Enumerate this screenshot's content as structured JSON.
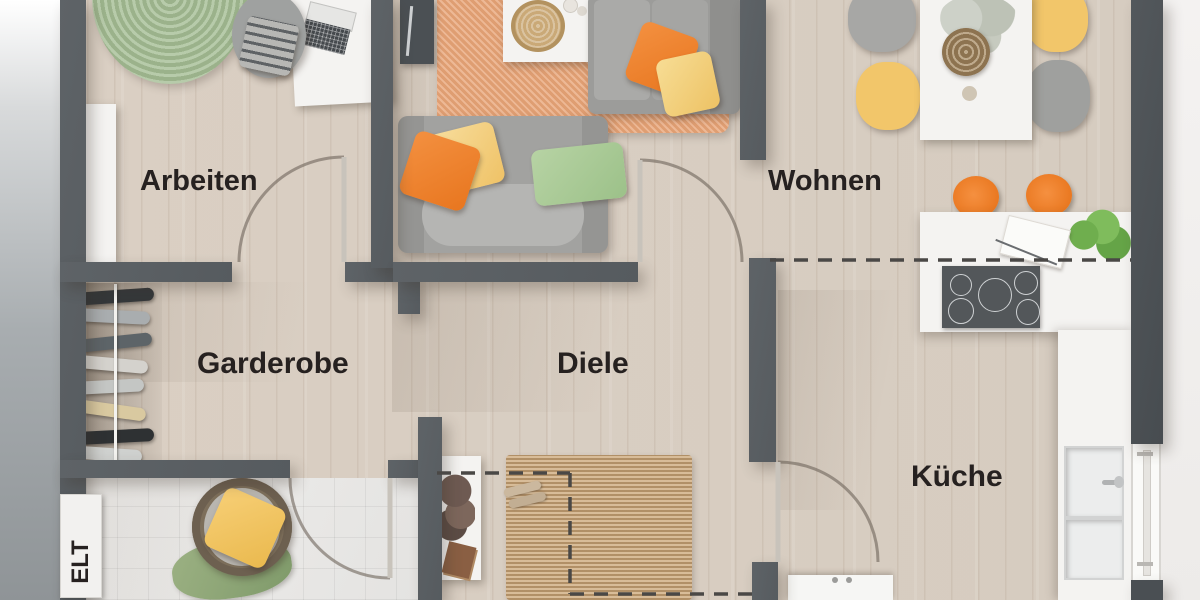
{
  "rooms": [
    {
      "id": "arbeiten",
      "label": "Arbeiten"
    },
    {
      "id": "wohnen",
      "label": "Wohnen"
    },
    {
      "id": "garderobe",
      "label": "Garderobe"
    },
    {
      "id": "diele",
      "label": "Diele"
    },
    {
      "id": "kueche",
      "label": "Küche"
    },
    {
      "id": "elt",
      "label": "ELT"
    }
  ],
  "palette": {
    "wall": "#5b6065",
    "floor_wood": "#d9cfc3",
    "floor_tile": "#e8e7e5",
    "rug_green": "#a3bc92",
    "rug_orange": "#e8a477",
    "rug_jute": "#c9a87e",
    "accent_orange": "#ef8030",
    "accent_yellow": "#f2c96d",
    "accent_green": "#a8cc96",
    "sofa_gray": "#9c9c9a",
    "label_text": "#262120",
    "dashed_line": "#4a4846"
  }
}
